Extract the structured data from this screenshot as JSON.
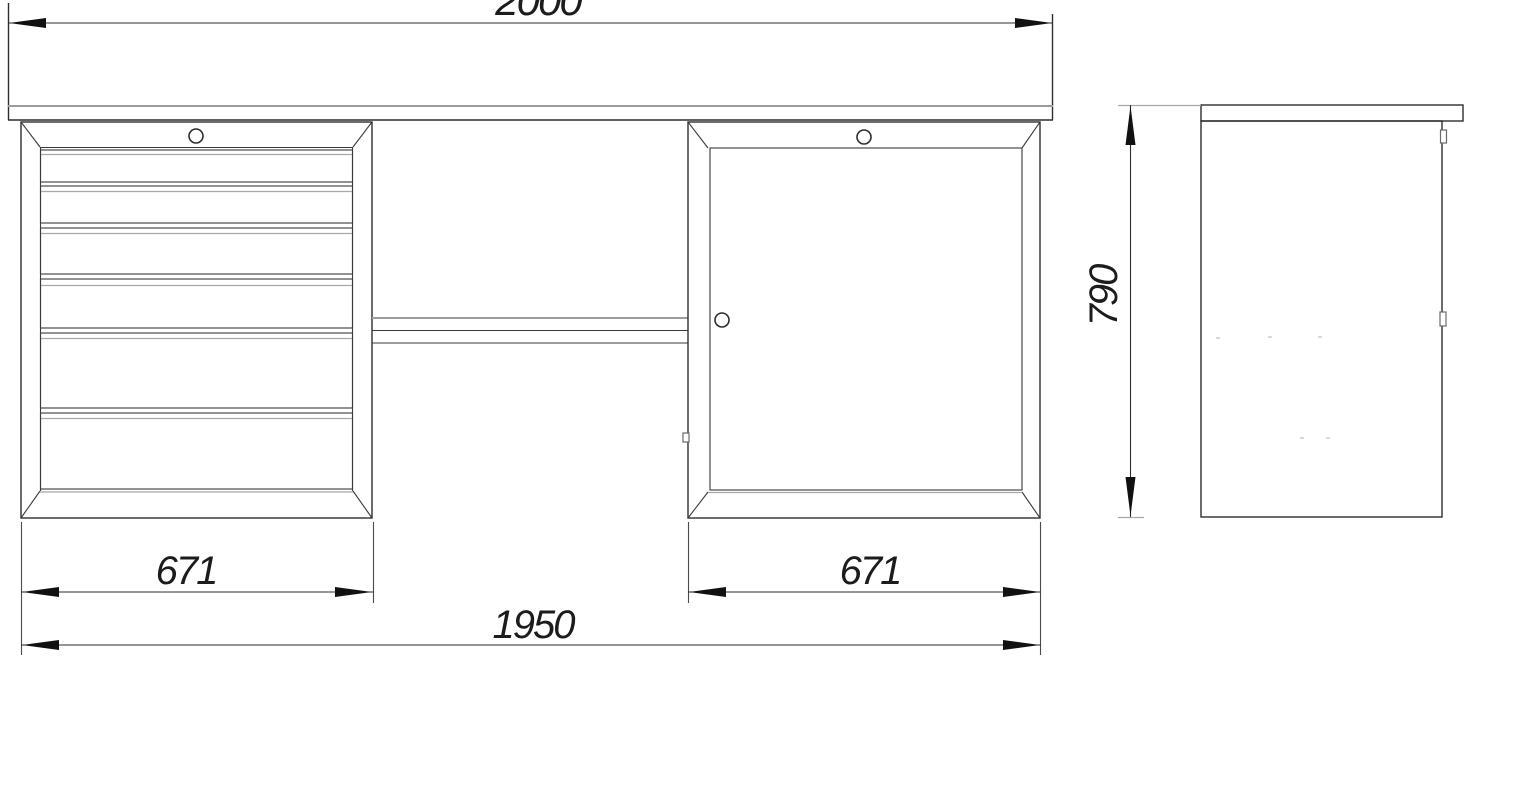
{
  "drawing": {
    "description": "Workbench engineering drawing with front view and side view",
    "dimensions": {
      "overall_width": "2000",
      "left_unit_width": "671",
      "right_unit_width": "671",
      "base_width": "1950",
      "height": "790"
    },
    "colors": {
      "line": "#2d2d2d",
      "accent_gray": "#9c9c9c",
      "background": "#ffffff"
    }
  }
}
